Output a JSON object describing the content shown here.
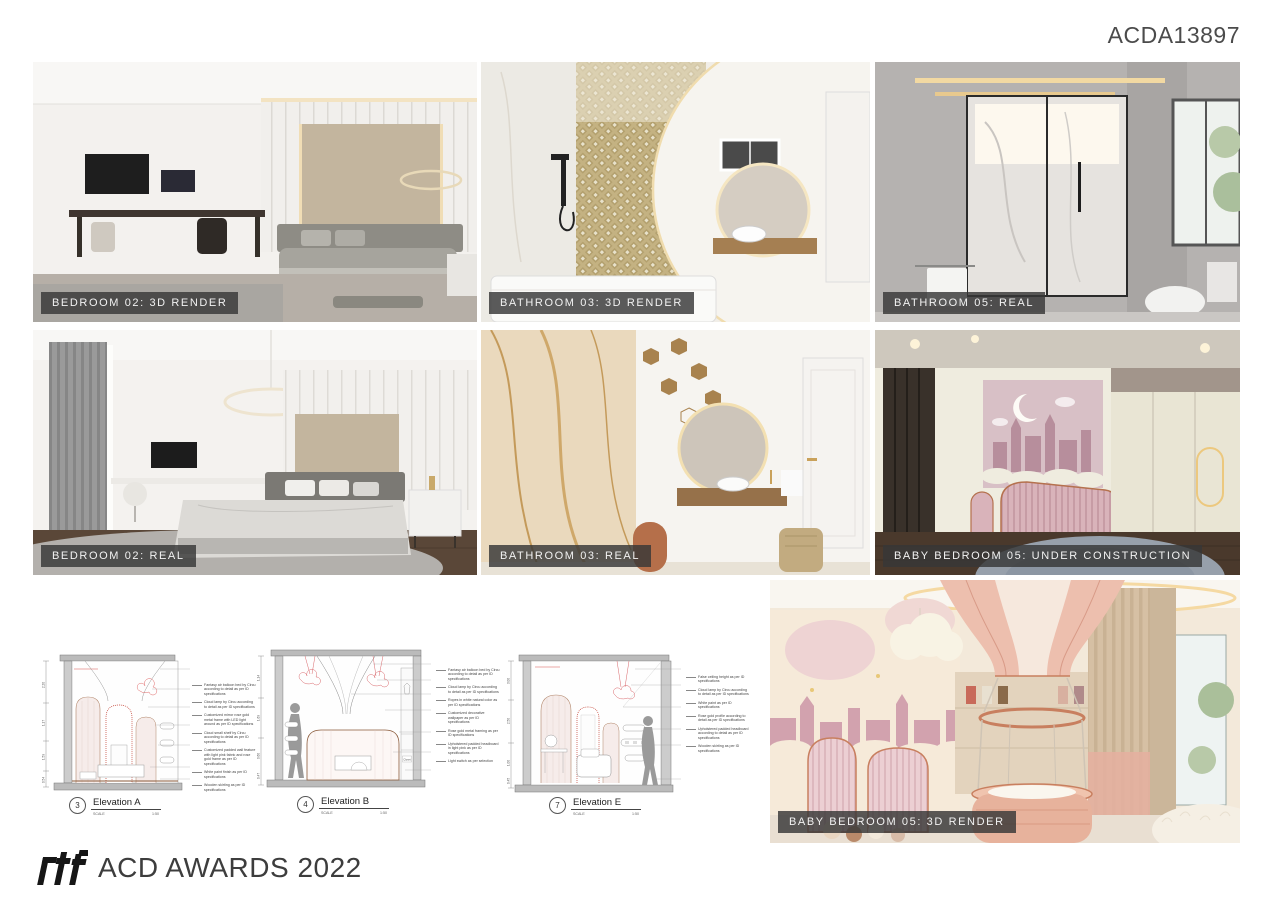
{
  "header": {
    "code": "ACDA13897"
  },
  "photos": [
    {
      "id": "bedroom-02-3d-render",
      "label": "BEDROOM 02: 3D RENDER"
    },
    {
      "id": "bathroom-03-3d-render",
      "label": "BATHROOM 03: 3D RENDER"
    },
    {
      "id": "bathroom-05-real",
      "label": "BATHROOM 05: REAL"
    },
    {
      "id": "bedroom-02-real",
      "label": "BEDROOM 02: REAL"
    },
    {
      "id": "bathroom-03-real",
      "label": "BATHROOM 03: REAL"
    },
    {
      "id": "baby-bedroom-05-under-construction",
      "label": "BABY BEDROOM 05: UNDER CONSTRUCTION"
    },
    {
      "id": "baby-bedroom-05-3d-render",
      "label": "BABY BEDROOM 05: 3D RENDER"
    }
  ],
  "elevations": [
    {
      "caption_number": "3",
      "caption_label": "Elevation A",
      "scale_label": "SCALE",
      "scale_value": "1:50",
      "dimensions": [
        "2.20",
        "1.17",
        "1.59",
        "0.54"
      ],
      "annotations": [
        "Fantasy air balloon bed by Circu according to detail as per ID specifications",
        "Cloud lamp by Circu according to detail as per ID specifications",
        "Customized mirror rose gold metal frame with LED light around as per ID specifications",
        "Cloud small shelf by Circu according to detail as per ID specifications",
        "Customized padded wall feature with light pink fabric and rose gold frame as per ID specifications",
        "White paint finish as per ID specifications",
        "Wooden skirting as per ID specifications"
      ]
    },
    {
      "caption_number": "4",
      "caption_label": "Elevation B",
      "scale_label": "SCALE",
      "scale_value": "1:50",
      "dimensions": [
        "1.14",
        "1.69",
        "0.60",
        "0.47"
      ],
      "closet_label": "Closet",
      "annotations": [
        "Fantasy air balloon bed by Circu according to detail as per ID specifications",
        "Cloud lamp by Circu according to detail as per ID specifications",
        "Ropes in white natural color as per ID specifications",
        "Customized decorative wallpaper as per ID specifications",
        "Rose gold metal framing as per ID specifications",
        "Upholstered padded headboard in light pink as per ID specifications",
        "Light switch as per selection"
      ]
    },
    {
      "caption_number": "7",
      "caption_label": "Elevation E",
      "scale_label": "SCALE",
      "scale_value": "1:50",
      "dimensions": [
        "3.00",
        "2.50",
        "1.00",
        "0.45"
      ],
      "annotations": [
        "False ceiling height as per ID specifications",
        "Cloud lamp by Circu according to detail as per ID specifications",
        "White paint as per ID specifications",
        "Rose gold profile according to detail as per ID specifications",
        "Upholstered padded headboard according to detail as per ID specifications",
        "Wooden skirting as per ID specifications"
      ]
    }
  ],
  "footer": {
    "logo": "rtf",
    "title": "ACD AWARDS 2022"
  },
  "colors": {
    "badge_bg": "#373737",
    "badge_text": "#f2f2f2",
    "accent_pink": "#e9c4c4",
    "accent_rosegold": "#b5714e",
    "drawing_red": "#d9534f"
  }
}
